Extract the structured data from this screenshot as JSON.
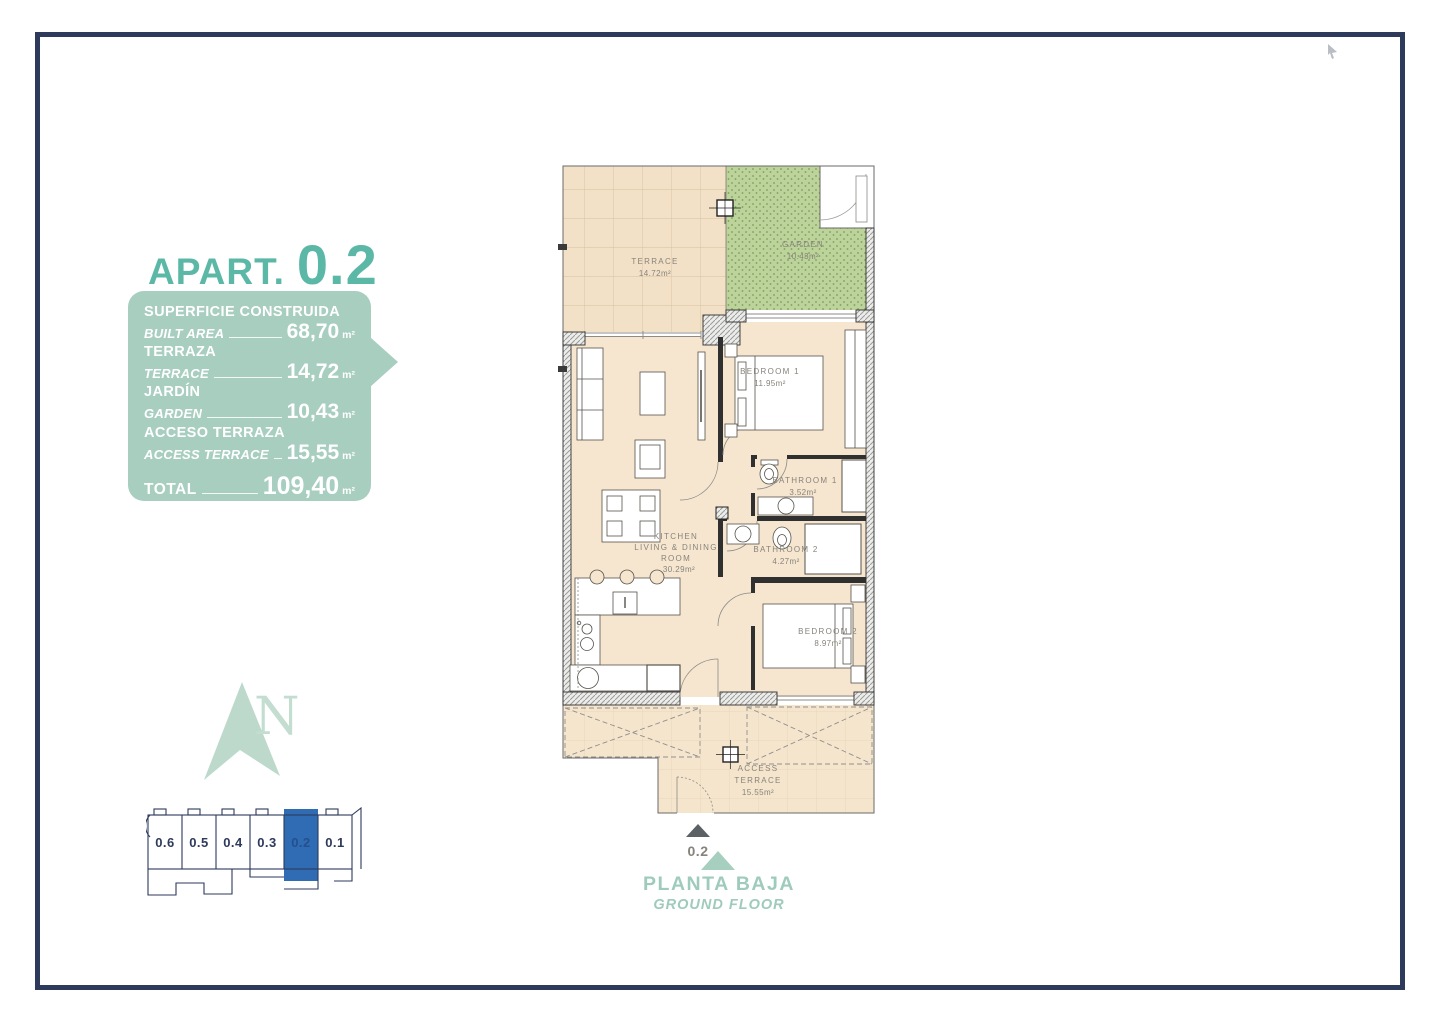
{
  "apartment": {
    "label": "APART.",
    "number": "0.2"
  },
  "summary": {
    "rows": [
      {
        "label_primary": "SUPERFICIE CONSTRUIDA",
        "label_secondary": "BUILT AREA",
        "value": "68,70",
        "unit": "m²"
      },
      {
        "label_primary": "TERRAZA",
        "label_secondary": "TERRACE",
        "value": "14,72",
        "unit": "m²"
      },
      {
        "label_primary": "JARDÍN",
        "label_secondary": "GARDEN",
        "value": "10,43",
        "unit": "m²"
      },
      {
        "label_primary": "ACCESO TERRAZA",
        "label_secondary": "ACCESS TERRACE",
        "value": "15,55",
        "unit": "m²"
      }
    ],
    "total": {
      "label": "TOTAL",
      "value": "109,40",
      "unit": "m²"
    }
  },
  "floor_plan": {
    "rooms": {
      "terrace": {
        "name": "TERRACE",
        "area": "14.72m²"
      },
      "garden": {
        "name": "GARDEN",
        "area": "10.43m²"
      },
      "bedroom1": {
        "name": "BEDROOM 1",
        "area": "11.95m²"
      },
      "bathroom1": {
        "name": "BATHROOM 1",
        "area": "3.52m²"
      },
      "bathroom2": {
        "name": "BATHROOM 2",
        "area": "4.27m²"
      },
      "bedroom2": {
        "name": "BEDROOM 2",
        "area": "8.97m²"
      },
      "kitchen": {
        "line1": "KITCHEN",
        "line2": "LIVING & DINING",
        "line3": "ROOM",
        "area": "30.29m²"
      },
      "access_terrace": {
        "line1": "ACCESS",
        "line2": "TERRACE",
        "area": "15.55m²"
      }
    },
    "entrance_label": "0.2"
  },
  "north_indicator": {
    "letter": "N"
  },
  "locator": {
    "units": [
      "0.6",
      "0.5",
      "0.4",
      "0.3",
      "0.2",
      "0.1"
    ],
    "highlighted_unit": "0.2",
    "highlight_color": "#2f6cb3"
  },
  "footer": {
    "floor_es": "PLANTA BAJA",
    "floor_en": "GROUND FLOOR"
  }
}
